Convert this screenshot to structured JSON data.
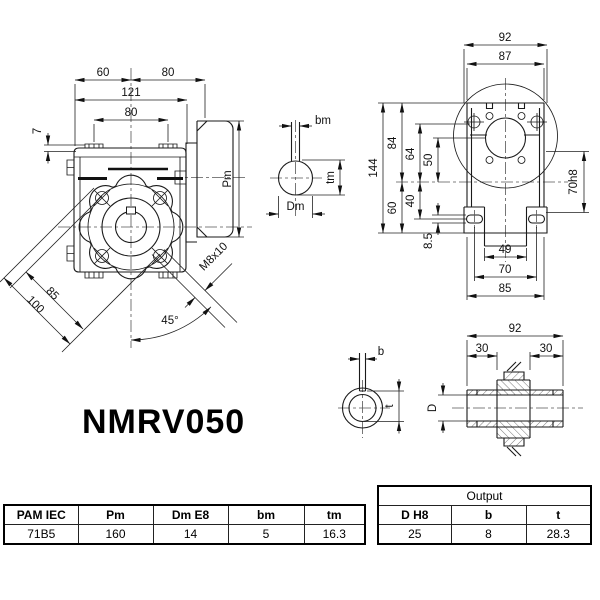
{
  "title": "NMRV050",
  "front": {
    "d60": "60",
    "d80top": "80",
    "d121": "121",
    "d80": "80",
    "d7": "7",
    "pm": "Pm",
    "d85": "85",
    "d100": "100",
    "m8": "M8x10",
    "a45": "45°"
  },
  "inkey": {
    "bm": "bm",
    "tm": "tm",
    "dm": "Dm"
  },
  "side": {
    "d92": "92",
    "d87": "87",
    "d144": "144",
    "d84": "84",
    "d64": "64",
    "d50": "50",
    "d60": "60",
    "d40": "40",
    "d85s": "8.5",
    "d70h8": "70h8",
    "d49": "49",
    "d70": "70",
    "d85b": "85"
  },
  "outkey": {
    "b": "b",
    "t": "t"
  },
  "shaft": {
    "d92": "92",
    "d30l": "30",
    "d30r": "30",
    "dd": "D"
  },
  "tables": {
    "main": {
      "headers": [
        "PAM IEC",
        "Pm",
        "Dm E8",
        "bm",
        "tm"
      ],
      "row": [
        "71B5",
        "160",
        "14",
        "5",
        "16.3"
      ]
    },
    "output": {
      "title": "Output",
      "headers": [
        "D H8",
        "b",
        "t"
      ],
      "row": [
        "25",
        "8",
        "28.3"
      ]
    }
  }
}
